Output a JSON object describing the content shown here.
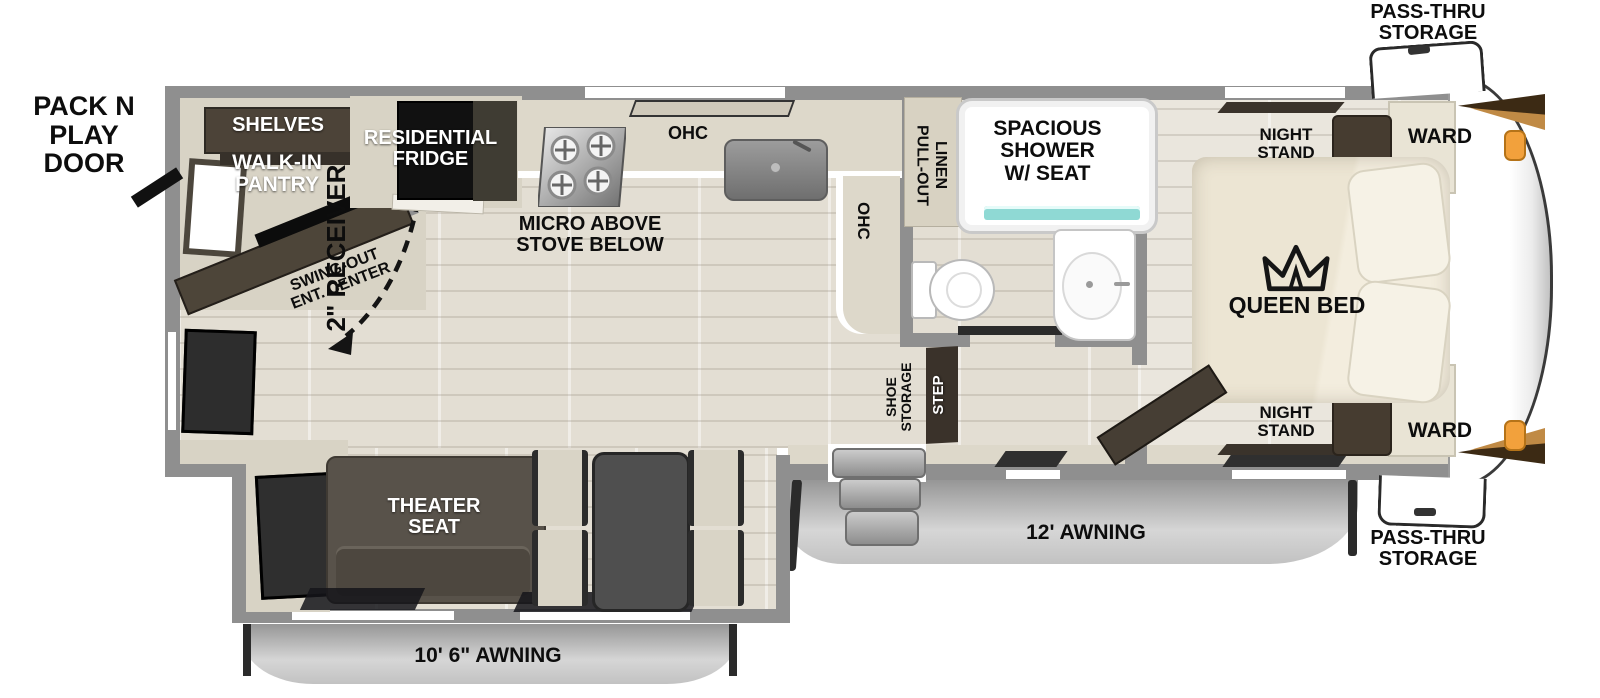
{
  "title": "Fifth wheel RV floor plan",
  "labels": {
    "pack_n_play_door": "PACK N PLAY\nDOOR",
    "receiver": "2\" RECEIVER",
    "shelves": "SHELVES",
    "walk_in_pantry": "WALK-IN\nPANTRY",
    "residential_fridge": "RESIDENTIAL\nFRIDGE",
    "swing_out_ent_center": "SWING-OUT\nENT. CENTER",
    "micro_above_stove": "MICRO ABOVE\nSTOVE BELOW",
    "ohc_kitchen_top": "OHC",
    "ohc_kitchen_side": "OHC",
    "pull_out_linen": "PULL-OUT\nLINEN",
    "spacious_shower": "SPACIOUS\nSHOWER\nW/ SEAT",
    "night_stand_top": "NIGHT\nSTAND",
    "night_stand_bottom": "NIGHT\nSTAND",
    "ward_top": "WARD",
    "ward_bottom": "WARD",
    "queen_bed": "QUEEN BED",
    "shoe_storage": "SHOE\nSTORAGE",
    "step": "STEP",
    "theater_seat": "THEATER\nSEAT",
    "awning_main": "12' AWNING",
    "awning_slide": "10' 6\" AWNING",
    "pass_thru_storage_top": "PASS-THRU\nSTORAGE",
    "pass_thru_storage_bottom": "PASS-THRU\nSTORAGE"
  },
  "colors": {
    "wall_gray": "#8f8f8f",
    "cabinet_dark_brown": "#4a4238",
    "cabinet_black": "#1a1a1a",
    "counter_beige": "#ddd8ca",
    "floor_wood": "#e3ded3",
    "floor_bedroom": "#eae6dd",
    "theater_seat": "#57514a",
    "awning_gray": "#c7c7c7",
    "shower_glass_teal": "#8fd9d4",
    "cap_accent_orange": "#f2a13c",
    "cap_accent_brown": "#3c2a14",
    "label_black": "#0d0d0d",
    "label_white": "#ffffff"
  }
}
